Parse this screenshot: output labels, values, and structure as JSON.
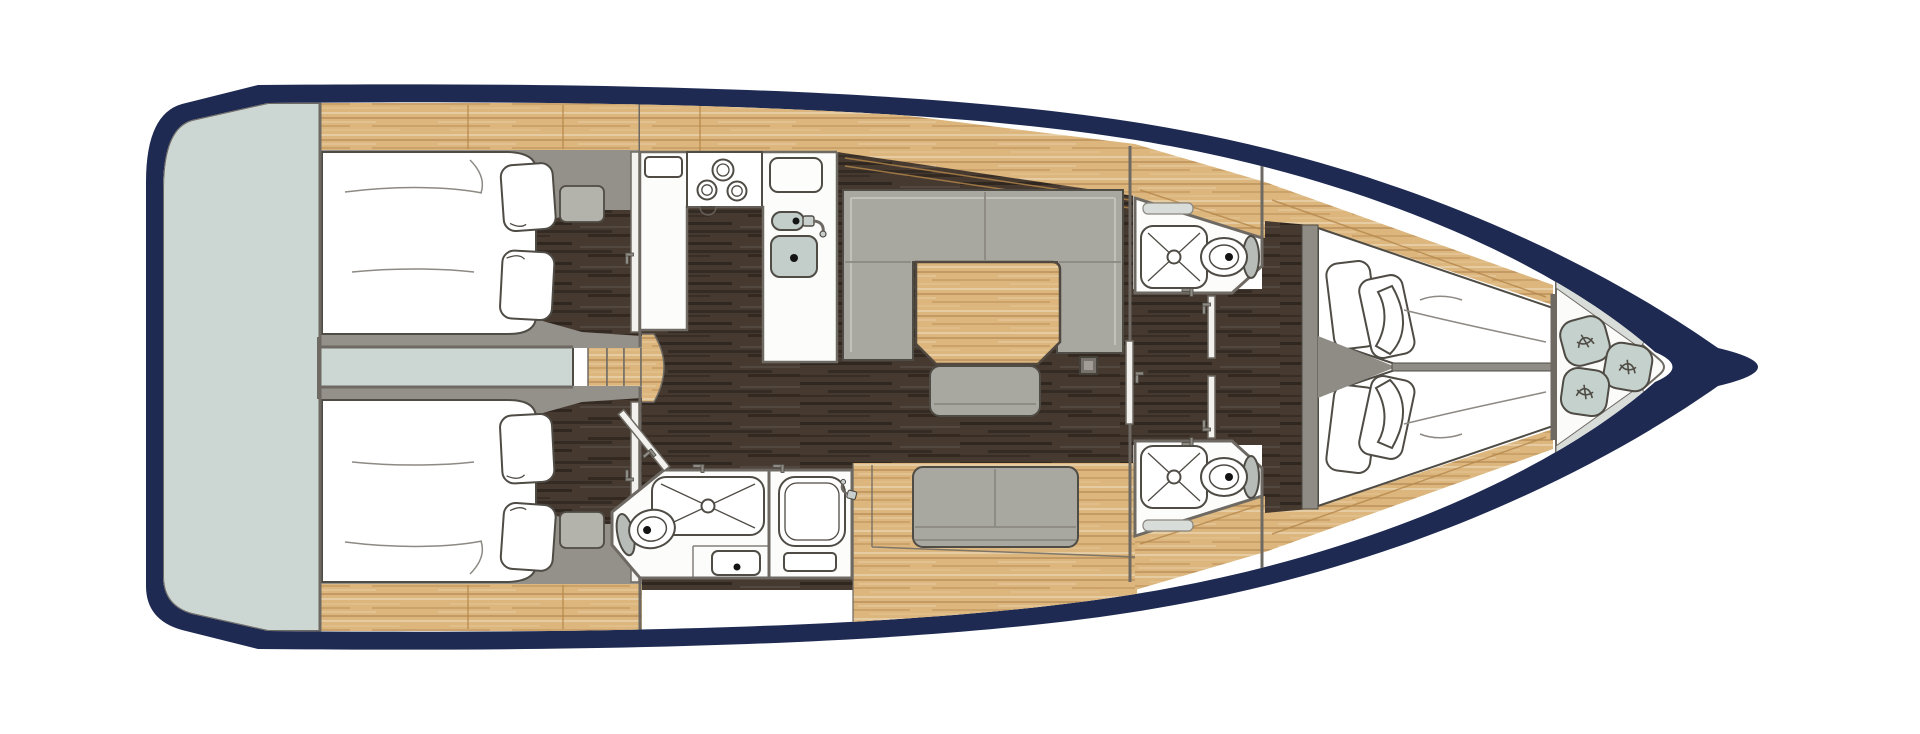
{
  "canvas": {
    "width": 1920,
    "height": 734,
    "background": "#ffffff"
  },
  "diagram": {
    "type": "boat-floor-plan",
    "view": "top-down",
    "subject": "sailing-yacht-interior-layout"
  },
  "colors": {
    "hull": "#1e2a52",
    "deckWhite": "#ffffff",
    "platform": "#ccd6d2",
    "wood": "#dcb67c",
    "woodLine": "#b5874b",
    "floorDark": "#463a30",
    "fabric": "#a8a7a0",
    "fabricDark": "#8f8c85",
    "graySurround": "#94908a",
    "wall": "#6e6a63",
    "stroke": "#4f4b45",
    "sinkFill": "#c3cecb",
    "cushion": "#c5d1cc",
    "trimGray": "#d9ddd9",
    "doorWhite": "#f2f1ee",
    "ventGray": "#d9ddd9",
    "lidGray": "#b7bcb8"
  },
  "rooms": [
    {
      "name": "swim-platform",
      "fixtures": [
        "transom-deck"
      ]
    },
    {
      "name": "aft-cabin-starboard",
      "fixtures": [
        "double-berth",
        "pillow",
        "pillow",
        "wardrobe",
        "cabin-door",
        "seat-step"
      ]
    },
    {
      "name": "aft-cabin-port",
      "fixtures": [
        "double-berth",
        "pillow",
        "pillow",
        "wardrobe",
        "cabin-door",
        "seat-step"
      ]
    },
    {
      "name": "companionway",
      "fixtures": [
        "steps",
        "engine-space"
      ]
    },
    {
      "name": "galley",
      "fixtures": [
        "stove-3-burner",
        "double-sink",
        "faucet",
        "icebox",
        "worktop"
      ]
    },
    {
      "name": "saloon",
      "fixtures": [
        "u-shaped-sofa",
        "dining-table",
        "bench-seat",
        "settee-two-seat",
        "mast-post",
        "floorboards"
      ]
    },
    {
      "name": "aft-head",
      "fixtures": [
        "toilet",
        "washbasin",
        "shower-tray",
        "shower-cabin",
        "faucet",
        "open-door"
      ]
    },
    {
      "name": "forward-head-starboard",
      "fixtures": [
        "toilet",
        "shower-tray",
        "vent-locker",
        "door"
      ]
    },
    {
      "name": "forward-head-port",
      "fixtures": [
        "toilet",
        "shower-tray",
        "vent-locker",
        "door"
      ]
    },
    {
      "name": "forward-cabin",
      "fixtures": [
        "v-berth-starboard",
        "v-berth-port",
        "pillows",
        "headboard-pads",
        "cabin-door"
      ]
    },
    {
      "name": "bow-locker",
      "fixtures": [
        "cushion",
        "cushion",
        "cushion"
      ]
    }
  ]
}
